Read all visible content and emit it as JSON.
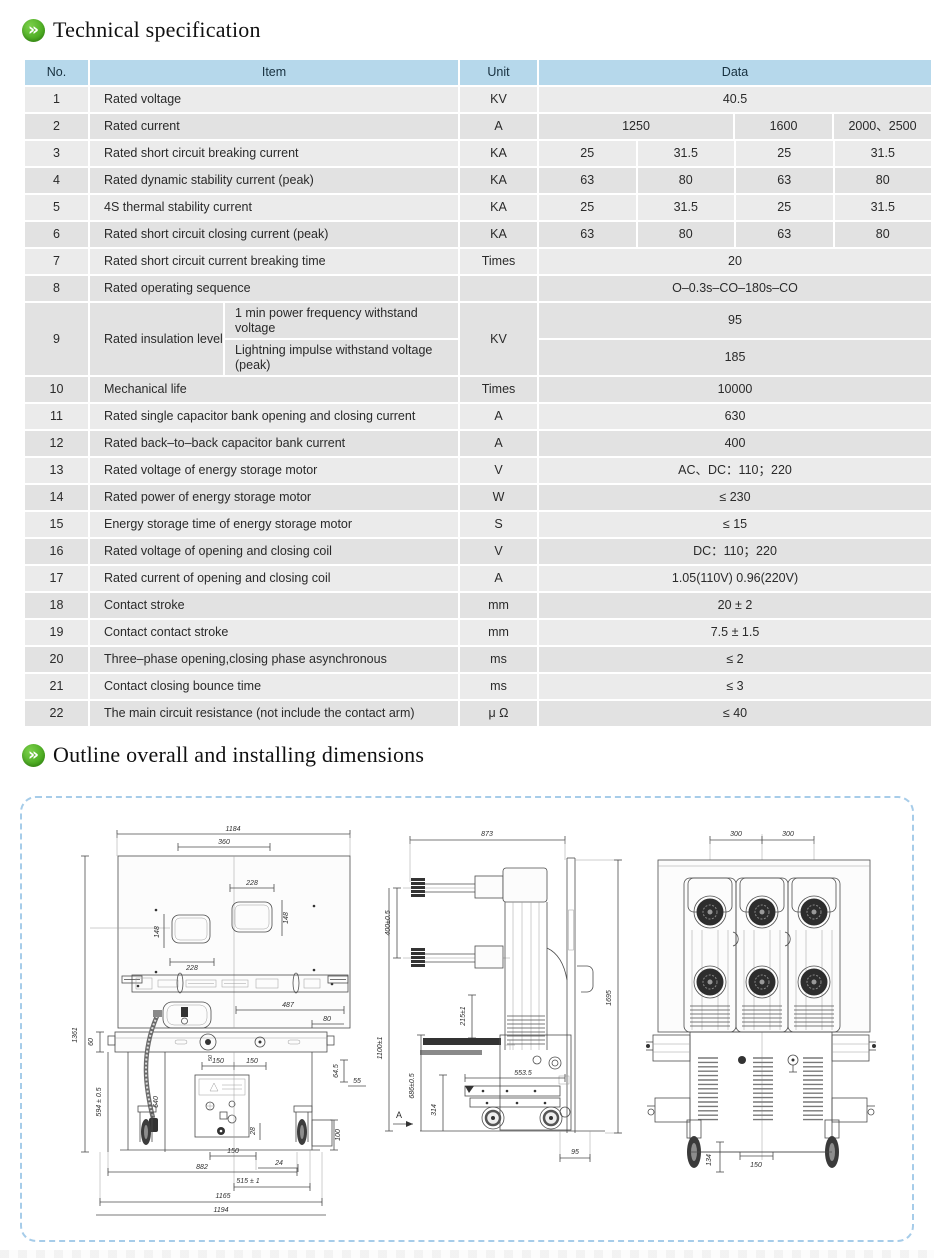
{
  "sections": {
    "spec_title": "Technical specification",
    "outline_title": "Outline overall and installing dimensions",
    "icon_glyph": "»"
  },
  "colors": {
    "accent_green": "#46a71d",
    "header_blue": "#b6d8eb",
    "row_gray": "#e4e4e4",
    "dashed_border": "#a6cce9"
  },
  "table": {
    "headers": {
      "no": "No.",
      "item": "Item",
      "unit": "Unit",
      "data": "Data"
    },
    "rows": [
      {
        "no": "1",
        "item": "Rated voltage",
        "unit": "KV",
        "d": [
          "40.5"
        ]
      },
      {
        "no": "2",
        "item": "Rated current",
        "unit": "A",
        "d": [
          "1250",
          "1600",
          "2000、2500"
        ]
      },
      {
        "no": "3",
        "item": "Rated short circuit breaking current",
        "unit": "KA",
        "d": [
          "25",
          "31.5",
          "25",
          "31.5"
        ]
      },
      {
        "no": "4",
        "item": "Rated dynamic stability current (peak)",
        "unit": "KA",
        "d": [
          "63",
          "80",
          "63",
          "80"
        ]
      },
      {
        "no": "5",
        "item": "4S thermal stability current",
        "unit": "KA",
        "d": [
          "25",
          "31.5",
          "25",
          "31.5"
        ]
      },
      {
        "no": "6",
        "item": "Rated short circuit closing current (peak)",
        "unit": "KA",
        "d": [
          "63",
          "80",
          "63",
          "80"
        ]
      },
      {
        "no": "7",
        "item": "Rated short circuit  current breaking time",
        "unit": "Times",
        "d": [
          "20"
        ]
      },
      {
        "no": "8",
        "item": "Rated operating sequence",
        "unit": "",
        "d": [
          "O–0.3s–CO–180s–CO"
        ]
      },
      {
        "no": "9",
        "item": "Rated insulation level",
        "unit": "KV",
        "sub": [
          {
            "label": "1 min power frequency withstand voltage",
            "value": "95"
          },
          {
            "label": "Lightning impulse withstand voltage (peak)",
            "value": "185"
          }
        ]
      },
      {
        "no": "10",
        "item": "Mechanical life",
        "unit": "Times",
        "d": [
          "10000"
        ]
      },
      {
        "no": "11",
        "item": "Rated single capacitor bank opening and closing current",
        "unit": "A",
        "d": [
          "630"
        ]
      },
      {
        "no": "12",
        "item": "Rated back–to–back capacitor bank current",
        "unit": "A",
        "d": [
          "400"
        ]
      },
      {
        "no": "13",
        "item": "Rated voltage of energy storage motor",
        "unit": "V",
        "d": [
          "AC、DC：110；220"
        ]
      },
      {
        "no": "14",
        "item": "Rated power of energy storage motor",
        "unit": "W",
        "d": [
          "≤ 230"
        ]
      },
      {
        "no": "15",
        "item": "Energy storage time of energy storage motor",
        "unit": "S",
        "d": [
          "≤ 15"
        ]
      },
      {
        "no": "16",
        "item": "Rated voltage of opening and closing coil",
        "unit": "V",
        "d": [
          "DC：110；220"
        ]
      },
      {
        "no": "17",
        "item": "Rated current of opening and closing coil",
        "unit": "A",
        "d": [
          "1.05(110V)  0.96(220V)"
        ]
      },
      {
        "no": "18",
        "item": "Contact stroke",
        "unit": "mm",
        "d": [
          "20 ± 2"
        ]
      },
      {
        "no": "19",
        "item": "Contact contact stroke",
        "unit": "mm",
        "d": [
          "7.5 ± 1.5"
        ]
      },
      {
        "no": "20",
        "item": "Three–phase opening,closing phase asynchronous",
        "unit": "ms",
        "d": [
          "≤ 2"
        ]
      },
      {
        "no": "21",
        "item": "Contact closing bounce time",
        "unit": "ms",
        "d": [
          "≤ 3"
        ]
      },
      {
        "no": "22",
        "item": "The main circuit resistance (not include the contact arm)",
        "unit": "μ Ω",
        "d": [
          "≤ 40"
        ]
      }
    ]
  },
  "drawings": {
    "front": {
      "labels": [
        "1184",
        "360",
        "228",
        "148",
        "148",
        "228",
        "487",
        "80",
        "60",
        "1361",
        "594 ± 0.5",
        "640",
        "50",
        "150",
        "150",
        "64.5",
        "55",
        "28",
        "100",
        "150",
        "24",
        "882",
        "515 ± 1",
        "1165",
        "1194"
      ]
    },
    "side": {
      "labels": [
        "873",
        "400±0.5",
        "215±1",
        "1695",
        "1100±1",
        "686±0.5",
        "314",
        "A",
        "553.5",
        "95"
      ]
    },
    "rear": {
      "labels": [
        "300",
        "300",
        "150",
        "134"
      ]
    }
  }
}
